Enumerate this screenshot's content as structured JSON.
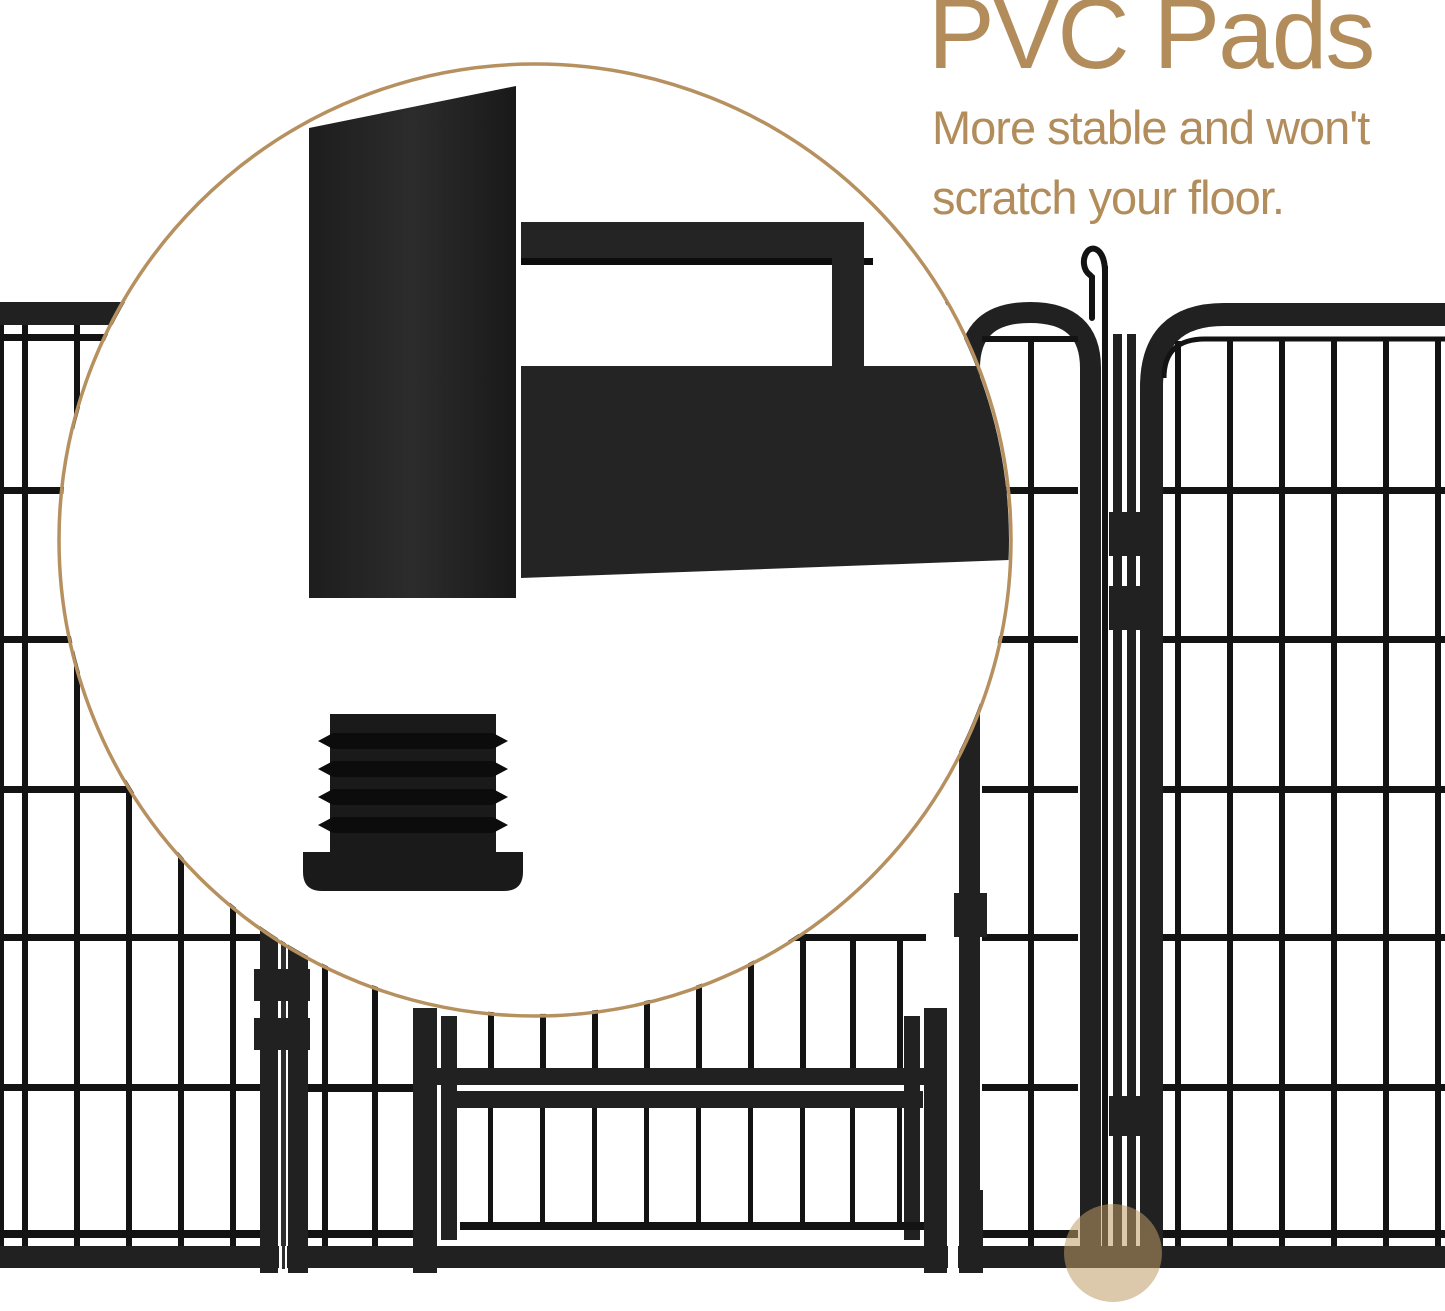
{
  "copy": {
    "heading": "PVC Pads",
    "line1": "More stable and won't",
    "line2": "scratch your floor."
  },
  "colors": {
    "accent": "#b28d5b",
    "ring": "#b6905e",
    "fence": "#212121",
    "bars": "#131313",
    "metal": "#242424",
    "metal_dark": "#0c0c0c",
    "plug": "#1a1a1a",
    "highlight": "rgba(192,154,102,0.55)",
    "background": "#ffffff"
  }
}
